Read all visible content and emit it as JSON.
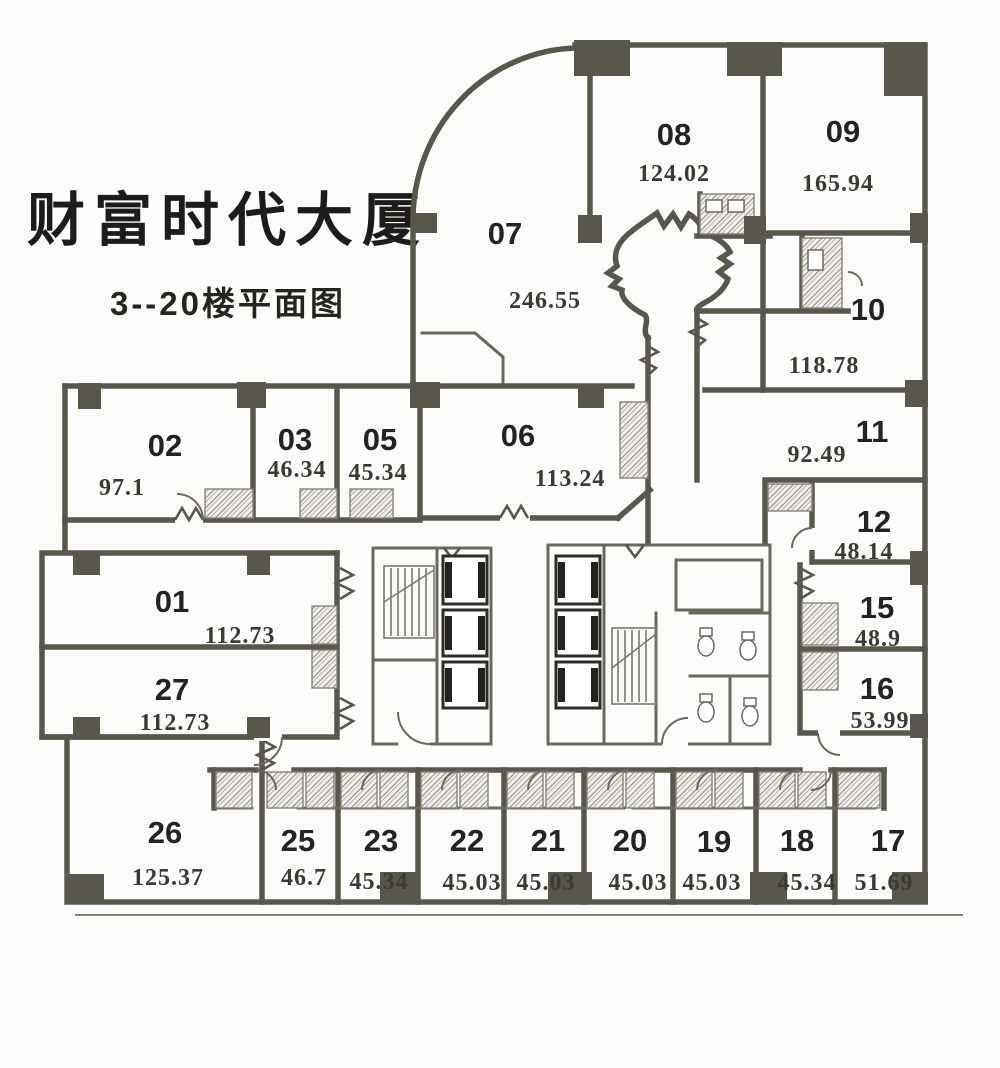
{
  "building": {
    "title": "财富时代大厦",
    "subtitle": "3--20楼平面图"
  },
  "colors": {
    "wall": "#59564c",
    "ink": "#24231f",
    "background": "#fcfcfb"
  },
  "rooms": [
    {
      "id": "01",
      "area": "112.73"
    },
    {
      "id": "02",
      "area": "97.1"
    },
    {
      "id": "03",
      "area": "46.34"
    },
    {
      "id": "05",
      "area": "45.34"
    },
    {
      "id": "06",
      "area": "113.24"
    },
    {
      "id": "07",
      "area": "246.55"
    },
    {
      "id": "08",
      "area": "124.02"
    },
    {
      "id": "09",
      "area": "165.94"
    },
    {
      "id": "10",
      "area": "118.78"
    },
    {
      "id": "11",
      "area": "92.49"
    },
    {
      "id": "12",
      "area": "48.14"
    },
    {
      "id": "15",
      "area": "48.9"
    },
    {
      "id": "16",
      "area": "53.99"
    },
    {
      "id": "17",
      "area": "51.69"
    },
    {
      "id": "18",
      "area": "45.34"
    },
    {
      "id": "19",
      "area": "45.03"
    },
    {
      "id": "20",
      "area": "45.03"
    },
    {
      "id": "21",
      "area": "45.03"
    },
    {
      "id": "22",
      "area": "45.03"
    },
    {
      "id": "23",
      "area": "45.34"
    },
    {
      "id": "25",
      "area": "46.7"
    },
    {
      "id": "26",
      "area": "125.37"
    },
    {
      "id": "27",
      "area": "112.73"
    }
  ]
}
